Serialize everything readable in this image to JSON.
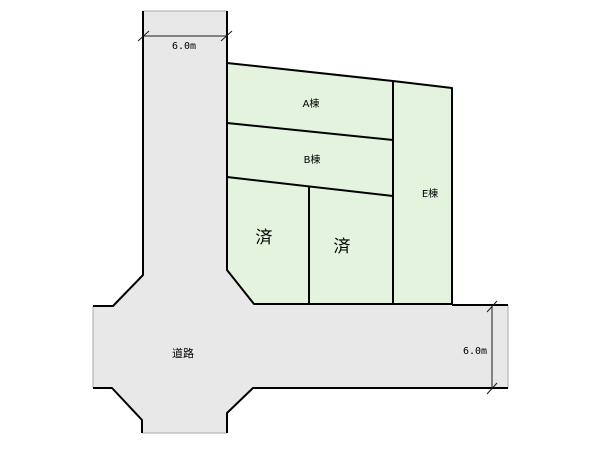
{
  "colors": {
    "road_fill": "#e8e8e8",
    "parcel_fill": "#e3f3dd",
    "line": "#000000",
    "open_end_line": "#aaaaaa"
  },
  "parcels": {
    "a": {
      "label": "A棟",
      "status": "available"
    },
    "b": {
      "label": "B棟",
      "status": "available"
    },
    "e": {
      "label": "E棟",
      "status": "available"
    },
    "sold_left": {
      "label": "済",
      "status": "sold"
    },
    "sold_right": {
      "label": "済",
      "status": "sold"
    }
  },
  "road": {
    "label": "道路"
  },
  "dimensions": {
    "top_road_width": "6.0m",
    "right_road_width": "6.0m"
  }
}
